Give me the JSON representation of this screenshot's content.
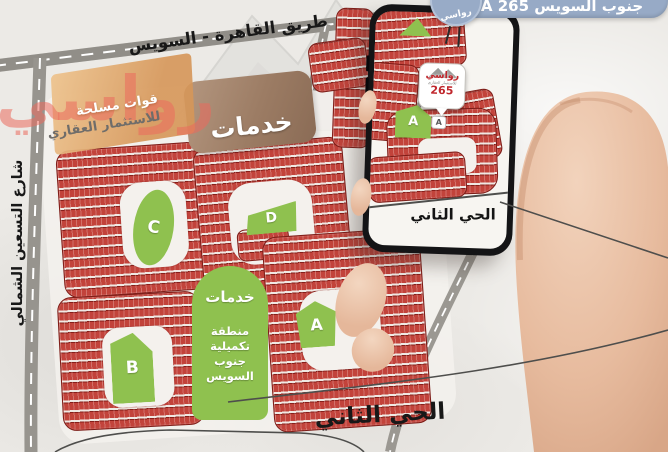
{
  "header": {
    "district_pill": "جنوب السويس A 265",
    "brand_badge": "رواسي"
  },
  "roads": {
    "cairo_suez": "طريق القاهرة - السويس",
    "north_ninety": "شارع التسعين الشمالي"
  },
  "logo": {
    "brand": "رواسي",
    "tagline1": "قوات مسلحة",
    "tagline2": "للاستثمار العقاري"
  },
  "map": {
    "services_top": "خدمات",
    "center_green": {
      "title": "خدمات",
      "lines": [
        "منطقة",
        "تكميلية",
        "جنوب",
        "السويس"
      ]
    },
    "district_label": "الحي الثاني",
    "block_a": "A",
    "block_b": "B",
    "block_c": "C",
    "block_d": "D"
  },
  "phone": {
    "pin_brand": "رواسي",
    "pin_sub": "للاستثمار العقاري",
    "pin_number": "265",
    "pin_block": "A",
    "block_a": "A",
    "district_label": "الحي الثاني"
  },
  "colors": {
    "plot_red": "#b8352e",
    "green": "#8fc14f",
    "brown": "#9c7c64",
    "badge_blue": "#97aac6",
    "pin_red": "#c0272d"
  }
}
